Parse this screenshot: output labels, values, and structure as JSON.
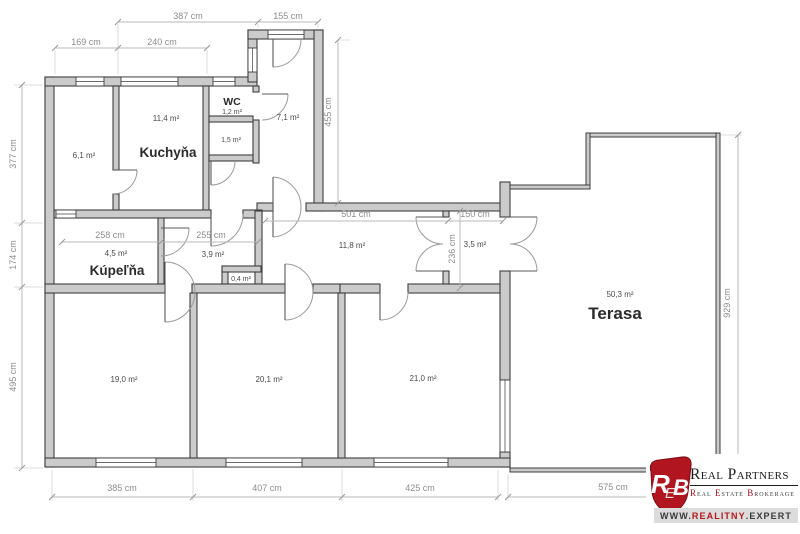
{
  "plan_title": "floor-plan",
  "dims": {
    "top_387": "387 cm",
    "top_155": "155 cm",
    "top_169": "169 cm",
    "top_240": "240 cm",
    "left_377": "377 cm",
    "left_174": "174 cm",
    "left_495": "495 cm",
    "mid_455": "455 cm",
    "mid_501": "501 cm",
    "mid_150": "150 cm",
    "mid_258": "258 cm",
    "mid_255": "255 cm",
    "mid_236": "236 cm",
    "right_929": "929 cm",
    "bottom_385": "385 cm",
    "bottom_407": "407 cm",
    "bottom_425": "425 cm",
    "bottom_575": "575 cm"
  },
  "rooms": {
    "room61": {
      "area": "6,1 m²"
    },
    "kuchyna": {
      "name": "Kuchyňa",
      "area": "11,4 m²"
    },
    "wc": {
      "name": "WC",
      "area": "1,2 m²"
    },
    "room15": {
      "area": "1,5 m²"
    },
    "hall71": {
      "area": "7,1 m²"
    },
    "corridor": {
      "area": "11,8 m²"
    },
    "vestibule": {
      "area": "3,5 m²"
    },
    "kupelna": {
      "name": "Kúpeľňa",
      "area": "4,5 m²"
    },
    "room39": {
      "area": "3,9 m²"
    },
    "closet": {
      "area": "0,4 m²"
    },
    "room190": {
      "area": "19,0 m²"
    },
    "room201": {
      "area": "20,1 m²"
    },
    "room210": {
      "area": "21,0 m²"
    },
    "terasa": {
      "name": "Terasa",
      "area": "50,3 m²"
    }
  },
  "logo": {
    "m1": "R",
    "m2": "E",
    "m3": "B",
    "title": "Real Partners",
    "w1i": "R",
    "w1r": "eal",
    "w2i": "E",
    "w2r": "state",
    "w3i": "B",
    "w3r": "rokerage",
    "web_pre": "www.",
    "web_mid": "realitny",
    "web_post": ".expert"
  },
  "colors": {
    "wall_fill": "#cbcbcb",
    "wall_line": "#3e3e3e",
    "dim_text": "#8c8c8c",
    "brand_red": "#b11520"
  }
}
